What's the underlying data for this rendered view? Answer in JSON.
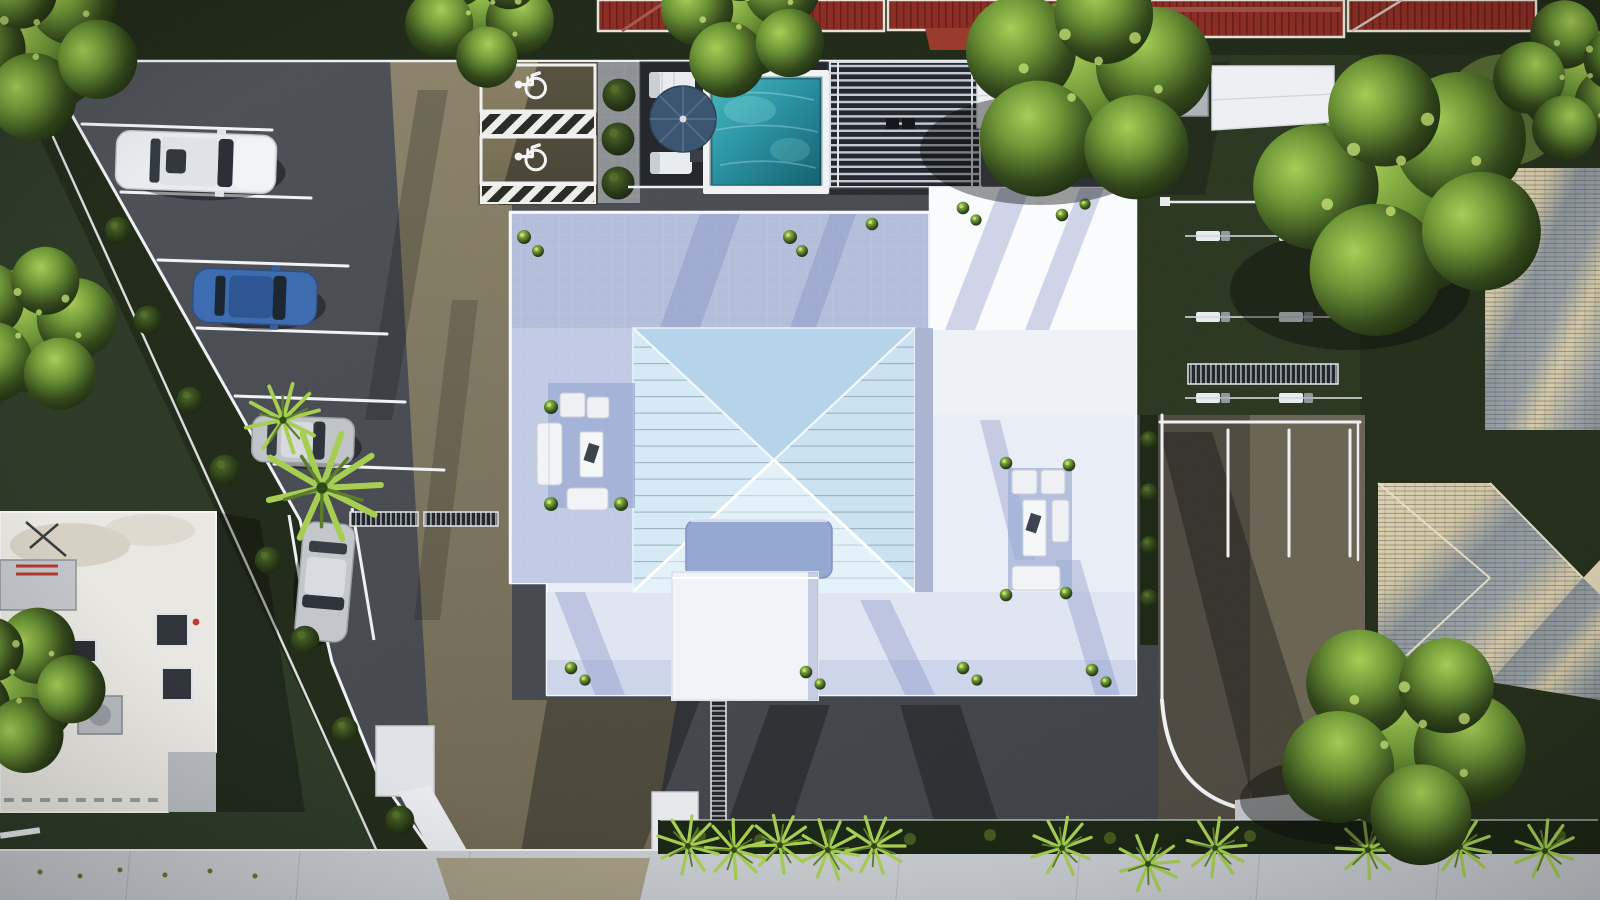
{
  "scene": {
    "title": "Aerial top-down 3D architectural rendering of a residential site plan with pool, parking lot and landscaping",
    "view": "top-down aerial",
    "style": "photorealistic 3D render, no visible text or UI",
    "palette": {
      "asphalt": "#45484e",
      "sunlit_paving": "#837a5e",
      "grass_dark": "#222d18",
      "grass_bright": "#5a7030",
      "foliage_highlight": "#a6cb55",
      "building_white": "#eef1f7",
      "terrace_shade_blue": "#b4bfdc",
      "hip_roof_blue": "#cde4f2",
      "pool_water": "#2f97a6",
      "umbrella_navy": "#3c5672",
      "red_tile_roof": "#8b2f27",
      "shingle_sunlit": "#d6cbaa",
      "shingle_shaded": "#8b949b",
      "sidewalk": "#c7cacf",
      "car_white": "#e9eaec",
      "car_blue": "#3e6cb0",
      "car_silver": "#bcc0c6",
      "line_white": "#f2f4f7"
    },
    "main_building": {
      "roof": "central light-blue hip roof with X ridge lines and seamed facets",
      "terrace": "white wrap-around roof terrace with blue-grey shaded zones",
      "annex": "white flat-roof wing on the south side with stair volume",
      "seating_groups": 2,
      "planters": "small potted plants along the deck edges"
    },
    "pool_area": {
      "pool": "rectangular turquoise pool with white coping",
      "umbrella": "round navy patio umbrella",
      "sun_loungers": 2,
      "pergola": "flat slatted pergola east of the pool",
      "round_shrubs": 3
    },
    "parking": {
      "surface": "dark asphalt with a sunlit sandy strip",
      "standard_stall_lines": 6,
      "accessible_stalls": 2,
      "access_aisle_hatches": 2,
      "cars": [
        {
          "color": "white",
          "type": "SUV",
          "position": "north angled stall"
        },
        {
          "color": "blue",
          "type": "sedan",
          "position": "middle angled stall"
        },
        {
          "color": "silver",
          "type": "hatchback",
          "position": "lower angled stall"
        },
        {
          "color": "silver",
          "type": "sedan",
          "position": "south bay, parked lengthwise"
        }
      ],
      "trench_drains": 2,
      "palm_overhang": 1
    },
    "rear_parking": {
      "stall_lines": 3,
      "curbs": "white painted curbs with rounded south corner",
      "surface": "brown asphalt, half in shadow"
    },
    "east_lawn": {
      "lounger_rows": 3,
      "dark_panel_strip": 1,
      "low_white_wall": 1
    },
    "street": {
      "sidewalk": "light concrete sidewalk along the south edge",
      "hedge": "clipped dark hedge with fan palms",
      "palm_count": 11,
      "driveway": "sand-coloured driveway apron crossing the sidewalk"
    },
    "neighbors": {
      "north": "red clay-tile roofs of adjacent buildings behind a fence line",
      "north_east": "white entry canopies and grey garden walls",
      "east": "cream house with grey shingle hip roof and paver strip",
      "south_west": "white flat-roof building with skylights, HVAC units and antenna"
    },
    "landscaping": {
      "large_trees": 3,
      "edge_trees": 5,
      "hedge_shrubs": 8,
      "round_bushes": 3
    }
  }
}
